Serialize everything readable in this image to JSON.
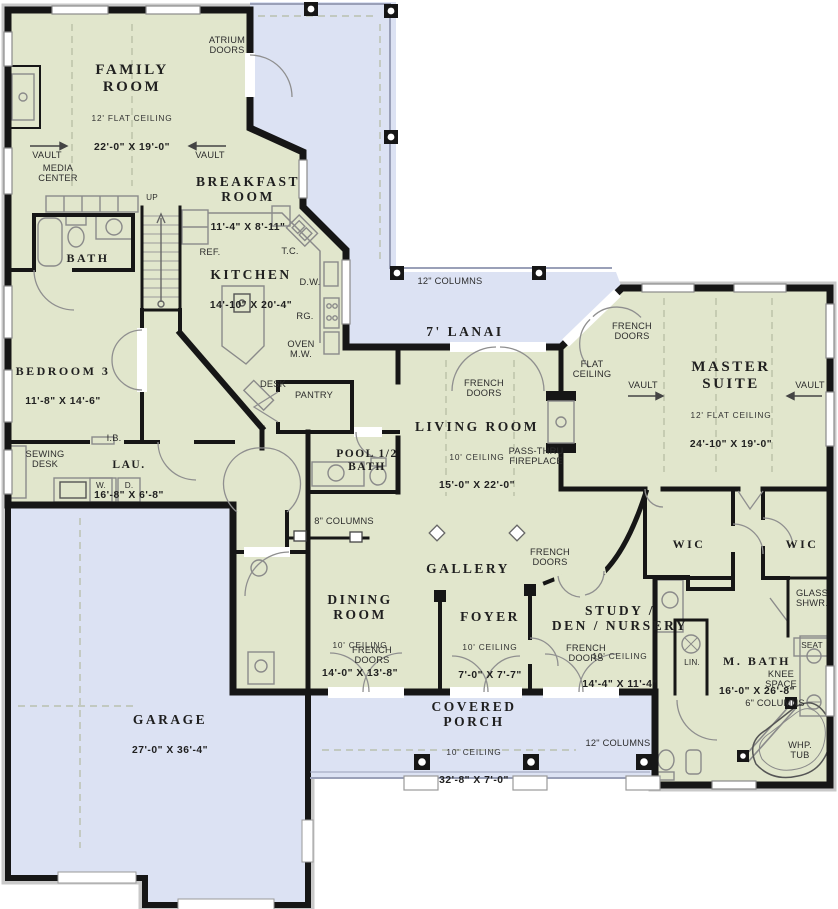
{
  "plan": {
    "type": "single-story house floor plan",
    "colors": {
      "room_fill": "#e1e6cc",
      "outdoor_fill": "#dce2f3",
      "wall": "#161616",
      "fixture_line": "#8a8a8a",
      "ceiling_dash": "#b3baa2",
      "text": "#1f1f1f"
    }
  },
  "rooms": {
    "family": {
      "name": "FAMILY\nROOM",
      "ceiling": "12' FLAT CEILING",
      "dims": "22'-0\" X 19'-0\""
    },
    "breakfast": {
      "name": "BREAKFAST\nROOM",
      "dims": "11'-4\" X 8'-11\""
    },
    "kitchen": {
      "name": "KITCHEN",
      "dims": "14'-10\" X 20'-4\""
    },
    "bath": {
      "name": "BATH"
    },
    "bedroom3": {
      "name": "BEDROOM 3",
      "dims": "11'-8\" X 14'-6\""
    },
    "laundry": {
      "name": "LAU.",
      "dims": "16'-8\" X 6'-8\""
    },
    "living": {
      "name": "LIVING ROOM",
      "ceiling": "10' CEILING",
      "dims": "15'-0\" X 22'-0\""
    },
    "master": {
      "name": "MASTER\nSUITE",
      "ceiling": "12' FLAT CEILING",
      "dims": "24'-10\" X 19'-0\""
    },
    "pool_bath": {
      "name": "POOL 1/2\nBATH"
    },
    "gallery": {
      "name": "GALLERY"
    },
    "dining": {
      "name": "DINING\nROOM",
      "ceiling": "10' CEILING",
      "dims": "14'-0\" X 13'-8\""
    },
    "foyer": {
      "name": "FOYER",
      "ceiling": "10' CEILING",
      "dims": "7'-0\" X 7'-7\""
    },
    "study": {
      "name": "STUDY /\nDEN / NURSERY",
      "ceiling": "10' CEILING",
      "dims": "14'-4\" X 11'-4\""
    },
    "wic_left": {
      "name": "WIC"
    },
    "wic_right": {
      "name": "WIC"
    },
    "master_bath": {
      "name": "M. BATH",
      "dims": "16'-0\" X 26'-8\""
    },
    "covered_porch": {
      "name": "COVERED\nPORCH",
      "ceiling": "10' CEILING",
      "dims": "32'-8\" X 7'-0\""
    },
    "garage": {
      "name": "GARAGE",
      "dims": "27'-0\" X 36'-4\""
    },
    "lanai": {
      "name": "7' LANAI"
    }
  },
  "annotations": {
    "atrium_doors": "ATRIUM\nDOORS",
    "vault_family_left": "VAULT",
    "vault_family_right": "VAULT",
    "media_center": "MEDIA\nCENTER",
    "up": "UP",
    "ref": "REF.",
    "tc": "T.C.",
    "dw": "D.W.",
    "rg": "RG.",
    "oven_mw": "OVEN\nM.W.",
    "desk": "DESK",
    "pantry": "PANTRY",
    "ib": "I.B.",
    "sewing_desk": "SEWING\nDESK",
    "washer": "W.",
    "dryer": "D.",
    "columns_12_lanai": "12\" COLUMNS",
    "french_doors_living": "FRENCH\nDOORS",
    "pass_thru_fireplace": "PASS-THRU\nFIREPLACE",
    "french_doors_master": "FRENCH\nDOORS",
    "flat_ceiling": "FLAT\nCEILING",
    "vault_master_left": "VAULT",
    "vault_master_right": "VAULT",
    "columns_8": "8\" COLUMNS",
    "french_doors_gallery": "FRENCH\nDOORS",
    "french_doors_dining": "FRENCH\nDOORS",
    "french_doors_study": "FRENCH\nDOORS",
    "glass_shwr": "GLASS\nSHWR.",
    "seat": "SEAT",
    "lin": "LIN.",
    "knee_space": "KNEE\nSPACE",
    "columns_6": "6\" COLUMNS",
    "whp_tub": "WHP.\nTUB",
    "columns_12_porch": "12\" COLUMNS"
  }
}
